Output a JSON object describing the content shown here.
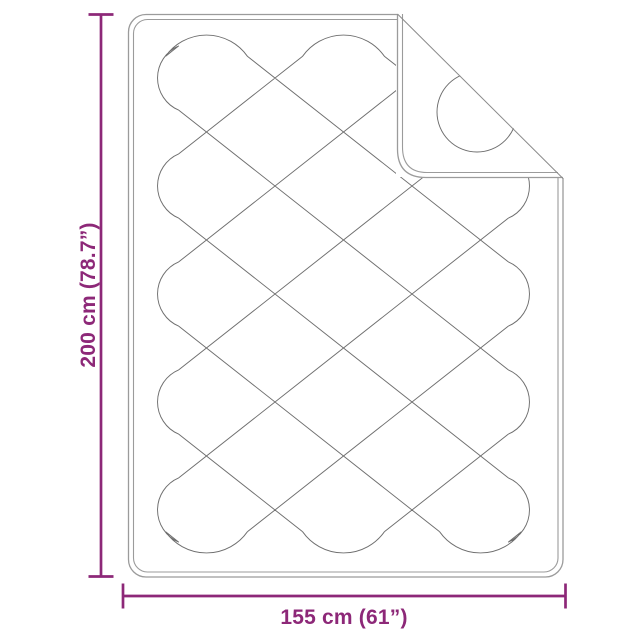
{
  "diagram": {
    "product": "quilted-blanket",
    "height_label": "200 cm (78.7”)",
    "width_label": "155 cm (61”)"
  },
  "colors": {
    "dimension": "#8D2878",
    "piping": "#9b9b9b",
    "stitch": "#6e6e6e",
    "fold_line": "#8a8a8a",
    "background": "#ffffff"
  }
}
